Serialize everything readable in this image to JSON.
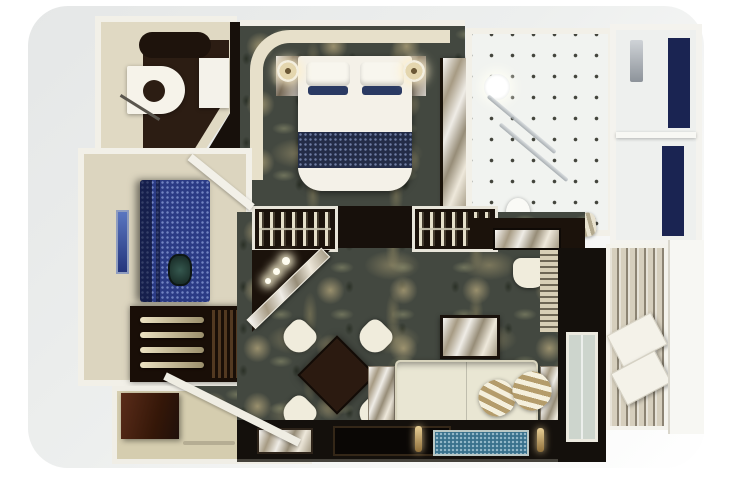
{
  "scene": {
    "type": "3d-floor-plan-render",
    "subject": "Top-down 3D rendering of a luxury suite floor plan",
    "width_px": 753,
    "height_px": 502,
    "visible_text": "none"
  },
  "palette": {
    "background": "#ffffff",
    "backdrop_gray": "#e7e9e9",
    "wall_white": "#f2f0e8",
    "wall_cream": "#e0d9c3",
    "headboard_cream": "#e7e0ca",
    "carpet_base": "#434840",
    "carpet_accent": "#b0a47a",
    "floor_cream": "#dcd5bf",
    "floor_entry": "#d5cdaf",
    "wood_dark": "#1b120b",
    "wood_hall": "#17100b",
    "wood_console": "#14100c",
    "wood_floor_office": "#2c1d13",
    "door_wood": "#4e2517",
    "tile_white": "#f1f3f0",
    "tile_dot": "#43443c",
    "marble": "#c6bca6",
    "navy_panel": "#1a2452",
    "bed_white": "#f4f1e8",
    "bed_runner_navy": "#232c47",
    "pillow_navy": "#2a3a63",
    "counter_blue": "#2b3b85",
    "art_blue": "#4a66b0",
    "sofa_cream": "#e9e6d3",
    "chair_cream": "#f0ecdc",
    "table_wood": "#2b1a10",
    "mosaic_blue": "#39718c",
    "gold": "#c8a764",
    "deck_plank": "#d6cfbd",
    "lounger_white": "#f4f2e9",
    "glass_green": "#cdd5cd",
    "bath_wing_white": "#eef0ee",
    "cabinet_dark": "#190e07",
    "decor_teal": "#1e3f3a"
  },
  "rooms": [
    {
      "id": "dressing-room",
      "name": "Dressing room with desk"
    },
    {
      "id": "bedroom",
      "name": "Bedroom with double bed"
    },
    {
      "id": "bathroom",
      "name": "Bathroom with tiled floor"
    },
    {
      "id": "shower-room",
      "name": "Shower room with navy glass panels"
    },
    {
      "id": "bar-lounge",
      "name": "Bar lounge with blue counter"
    },
    {
      "id": "living-room",
      "name": "Living and dining room"
    },
    {
      "id": "entry-hall",
      "name": "Entry hall"
    },
    {
      "id": "balcony",
      "name": "Balcony with deck loungers"
    }
  ],
  "furniture": {
    "bedroom": [
      "double-bed",
      "navy-bed-runner",
      "pillows",
      "nightstand-left",
      "nightstand-right",
      "round-lamps",
      "curved-headboard-wall"
    ],
    "bathroom": [
      "round-mirror-light",
      "glass-shower-screens",
      "toilet",
      "striped-towel",
      "marble-vanity"
    ],
    "shower_room": [
      "shower-column",
      "navy-glass-panels"
    ],
    "bar_lounge": [
      "blue-shimmer-counter",
      "wall-art",
      "decor-sculpture",
      "drinks-cabinet-shelves"
    ],
    "living_room": [
      "wardrobe-left",
      "wardrobe-right",
      "marble-console",
      "armchair",
      "dining-table",
      "dining-chairs-x4",
      "sofa",
      "striped-pillows-x2",
      "marble-coffee-table",
      "side-tables",
      "media-console",
      "blue-mosaic-runner",
      "console-lamps"
    ],
    "entry_hall": [
      "entry-door",
      "diagonal-marble-wall",
      "ceiling-spotlights-x3"
    ],
    "balcony": [
      "plank-deck",
      "lounger-x2",
      "balcony-door",
      "striped-curtain"
    ],
    "dressing_room": [
      "white-desk",
      "dark-bench",
      "cabinet",
      "chair"
    ]
  }
}
